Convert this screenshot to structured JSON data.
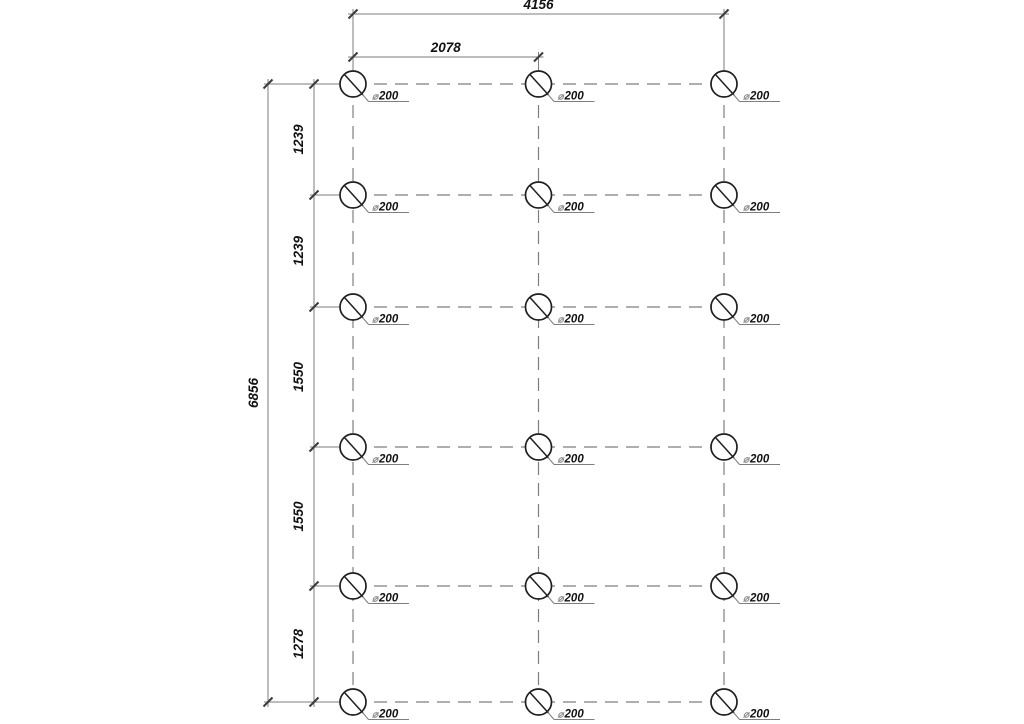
{
  "drawing": {
    "background": "#ffffff",
    "colors": {
      "thin_line": "#7e7e7e",
      "object_line": "#1f1f1f",
      "dim_text": "#121212",
      "diameter_symbol": "#8f8f8f",
      "tick": "#3c3c3c"
    },
    "grid": {
      "columns": 3,
      "rows": 6,
      "pile_count": 18
    },
    "piles": {
      "diameter_symbol": "⌀",
      "diameter_value": "200",
      "diameter_label": "⌀200"
    },
    "dimensions": {
      "horizontal": {
        "total": "4156",
        "first_bay": "2078"
      },
      "vertical": {
        "total": "6856",
        "segments": [
          "1239",
          "1239",
          "1550",
          "1550",
          "1278"
        ]
      }
    }
  }
}
